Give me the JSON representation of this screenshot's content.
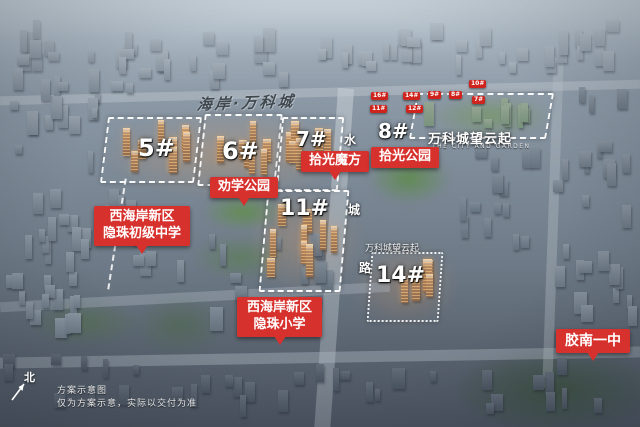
{
  "scene": {
    "watermark": "海岸·万科城",
    "compass": "北",
    "disclaimer_1": "方案示意图",
    "disclaimer_2": "仅为方案示意，实际以交付为准"
  },
  "plots": {
    "p5": "5#",
    "p6": "6#",
    "p7": "7#",
    "p8": "8#",
    "p11": "11#",
    "p14": "14#"
  },
  "markers": {
    "shiguang_mofang": "拾光魔方",
    "shiguang_park": "拾光公园",
    "quanxue_park": "劝学公园",
    "junior_high_line1": "西海岸新区",
    "junior_high_line2": "隐珠初级中学",
    "primary_line1": "西海岸新区",
    "primary_line2": "隐珠小学",
    "jiaonan": "胶南一中"
  },
  "project": {
    "name": "万科城望云起",
    "subtitle": "THE CITY AND GARDEN",
    "small_name": "万科城望云起"
  },
  "road": {
    "char1": "水",
    "char2": "城",
    "char3": "路"
  },
  "badges": {
    "b1": "16#",
    "b2": "11#",
    "b3": "14#",
    "b4": "12#",
    "b5": "9#",
    "b6": "8#",
    "b7": "10#",
    "b8": "7#"
  },
  "colors": {
    "marker_red": "#d7312d",
    "parcel_outline": "#ffffff",
    "watermark_gray": "#3f474f"
  }
}
